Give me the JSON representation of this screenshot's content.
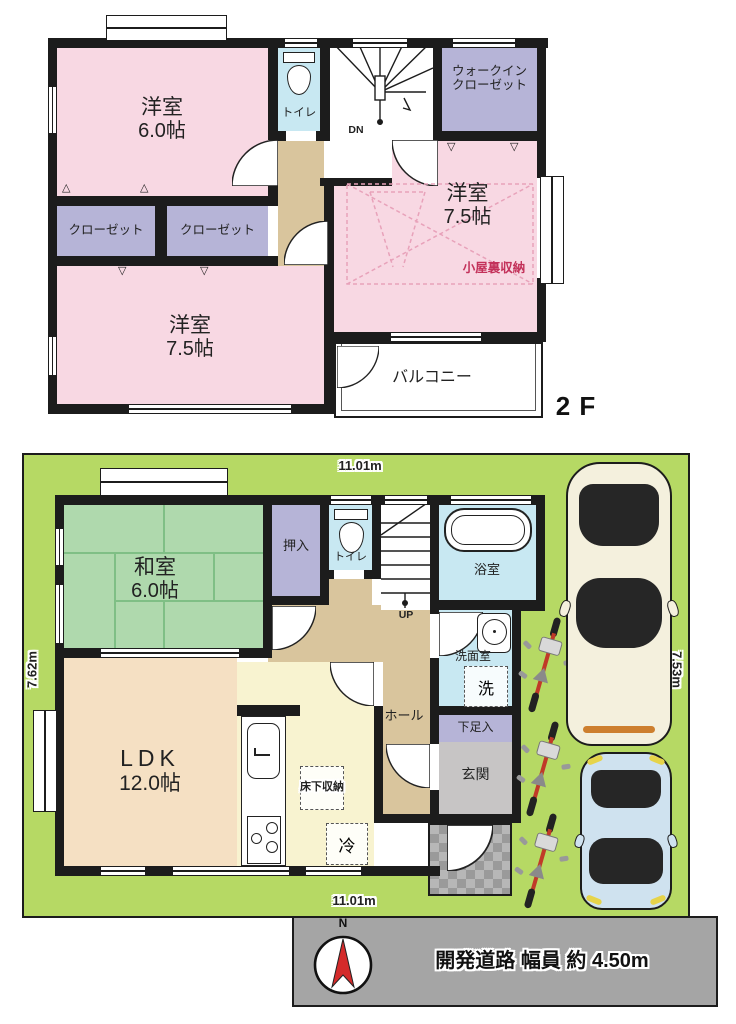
{
  "icons": {
    "marker_up": "△",
    "marker_down": "▽",
    "compass_north": "N"
  },
  "colors": {
    "wall": "#1c1c1c",
    "bedroom_pink": "#f8d8e3",
    "closet_lavender": "#b6b4d7",
    "toilet_blue": "#c8e8f2",
    "hall_tan": "#d9c59d",
    "lot_green": "#b6d964",
    "tatami_green": "#afd9ad",
    "ldk_peach": "#f5e0c3",
    "kitchen_yellow": "#f8f3d0",
    "entrance_gray": "#c7c5c5",
    "road_gray": "#a5a5a5",
    "attic_red": "#c3315a",
    "compass_red": "#d42a2a",
    "car_white": "#f4f0dd",
    "car_blue": "#cfe2ef",
    "bike_red": "#c03a28"
  },
  "floor2": {
    "label": "2 F",
    "stairs_label": "DN",
    "rooms": {
      "bedroom_60": {
        "name": "洋室",
        "size": "6.0帖"
      },
      "toilet": {
        "name": "トイレ"
      },
      "walkin_closet": {
        "line1": "ウォークイン",
        "line2": "クローゼット"
      },
      "bedroom_75_right": {
        "name": "洋室",
        "size": "7.5帖"
      },
      "attic_storage": {
        "name": "小屋裏収納"
      },
      "closet_left": {
        "name": "クローゼット"
      },
      "closet_right": {
        "name": "クローゼット"
      },
      "bedroom_75_left": {
        "name": "洋室",
        "size": "7.5帖"
      },
      "balcony": {
        "name": "バルコニー"
      }
    }
  },
  "floor1": {
    "stairs_label": "UP",
    "dimensions": {
      "top": "11.01m",
      "bottom": "11.01m",
      "left": "7.62m",
      "right": "7.53m"
    },
    "rooms": {
      "washitsu": {
        "name": "和室",
        "size": "6.0帖"
      },
      "oshiire": {
        "name": "押入"
      },
      "toilet": {
        "name": "トイレ"
      },
      "bathroom": {
        "name": "浴室"
      },
      "washroom": {
        "name": "洗面室"
      },
      "washer": {
        "name": "洗"
      },
      "hall": {
        "name": "ホール"
      },
      "shoe_cabinet": {
        "name": "下足入"
      },
      "entrance": {
        "name": "玄関"
      },
      "ldk": {
        "name": "LDK",
        "size": "12.0帖"
      },
      "underfloor_storage": {
        "name": "床下収納"
      },
      "refrigerator": {
        "name": "冷"
      }
    }
  },
  "road": {
    "label": "開発道路 幅員 約 4.50m"
  }
}
